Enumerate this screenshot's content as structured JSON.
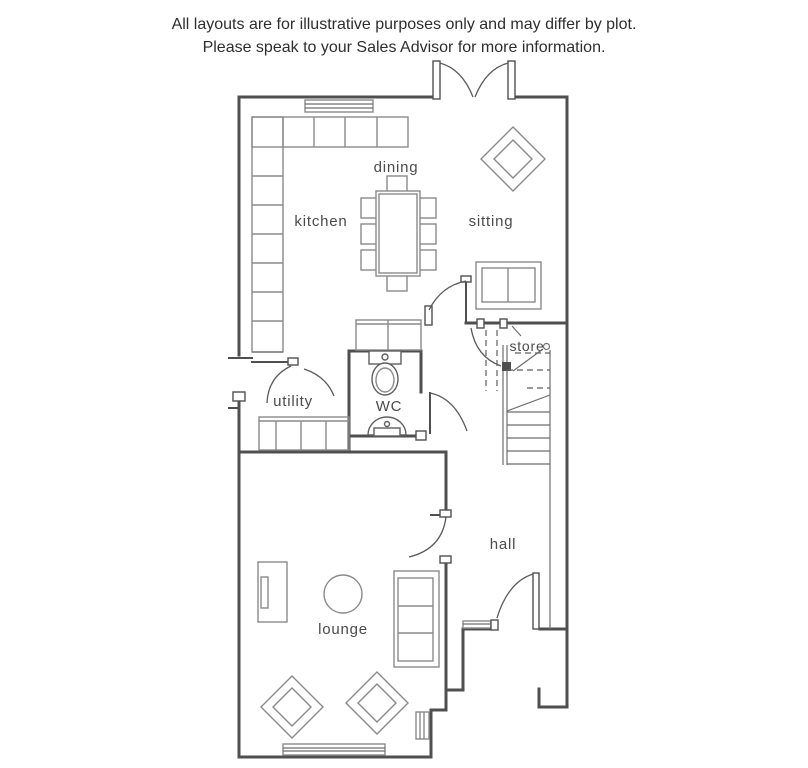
{
  "header": {
    "line1": "All layouts are for illustrative purposes only and may differ by plot.",
    "line2": "Please speak to your Sales Advisor for more information."
  },
  "rooms": {
    "kitchen": "kitchen",
    "dining": "dining",
    "sitting": "sitting",
    "store": "store",
    "utility": "utility",
    "wc": "WC",
    "hall": "hall",
    "lounge": "lounge"
  },
  "colors": {
    "wall": "#4f4f4f",
    "furniture": "#8a8a8a",
    "fixture": "#5f5f5f",
    "label": "#4a4a4a",
    "header_text": "#2e2e2e",
    "background": "#ffffff"
  }
}
